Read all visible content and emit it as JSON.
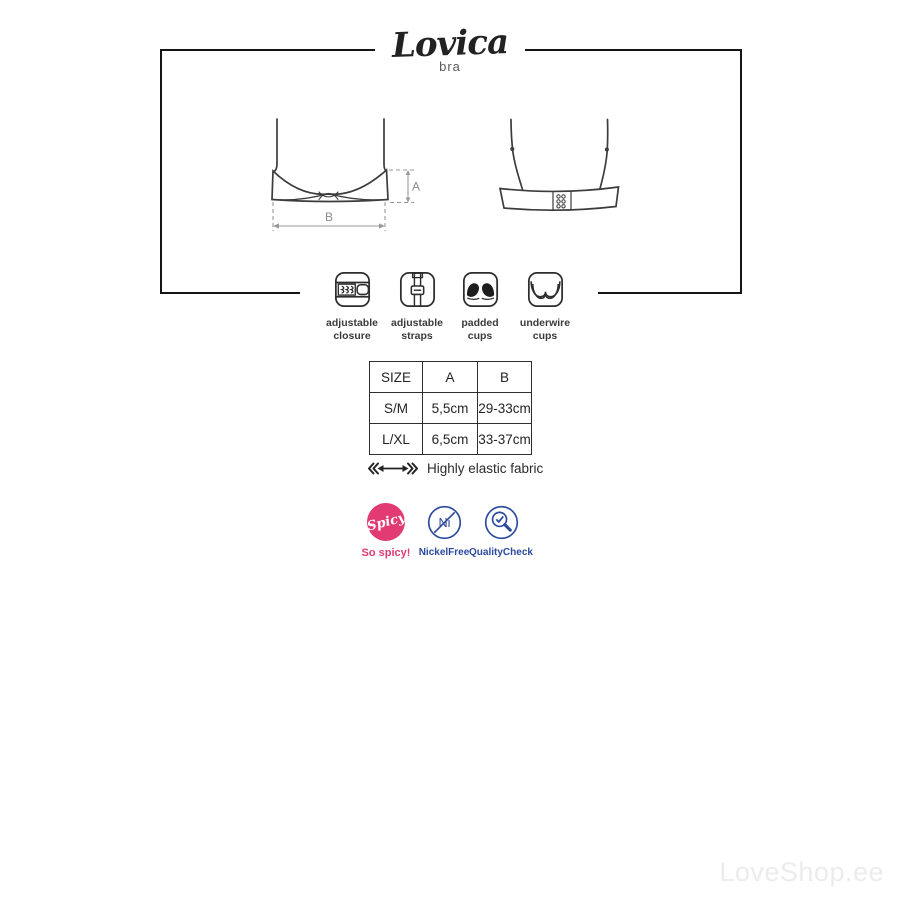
{
  "brand": {
    "name": "Lovica",
    "subtitle": "bra"
  },
  "diagram": {
    "dimension_labels": {
      "a": "A",
      "b": "B"
    }
  },
  "features": [
    {
      "icon": "adjustable-closure-icon",
      "label_line1": "adjustable",
      "label_line2": "closure"
    },
    {
      "icon": "adjustable-straps-icon",
      "label_line1": "adjustable",
      "label_line2": "straps"
    },
    {
      "icon": "padded-cups-icon",
      "label_line1": "padded",
      "label_line2": "cups"
    },
    {
      "icon": "underwire-cups-icon",
      "label_line1": "underwire",
      "label_line2": "cups"
    }
  ],
  "size_table": {
    "columns": [
      "SIZE",
      "A",
      "B"
    ],
    "rows": [
      {
        "size": "S/M",
        "a": "5,5cm",
        "b": "29-33cm"
      },
      {
        "size": "L/XL",
        "a": "6,5cm",
        "b": "33-37cm"
      }
    ]
  },
  "fabric_note": "Highly elastic fabric",
  "badges": {
    "spicy": {
      "circle_text": "Spicy",
      "label": "So spicy!",
      "color": "#e23a72"
    },
    "nickel_free": {
      "circle_text": "Ni",
      "label": "NickelFree",
      "color": "#2b4a9e"
    },
    "quality_check": {
      "label": "QualityCheck",
      "color": "#2b4a9e"
    }
  },
  "watermark": "LoveShop.ee"
}
